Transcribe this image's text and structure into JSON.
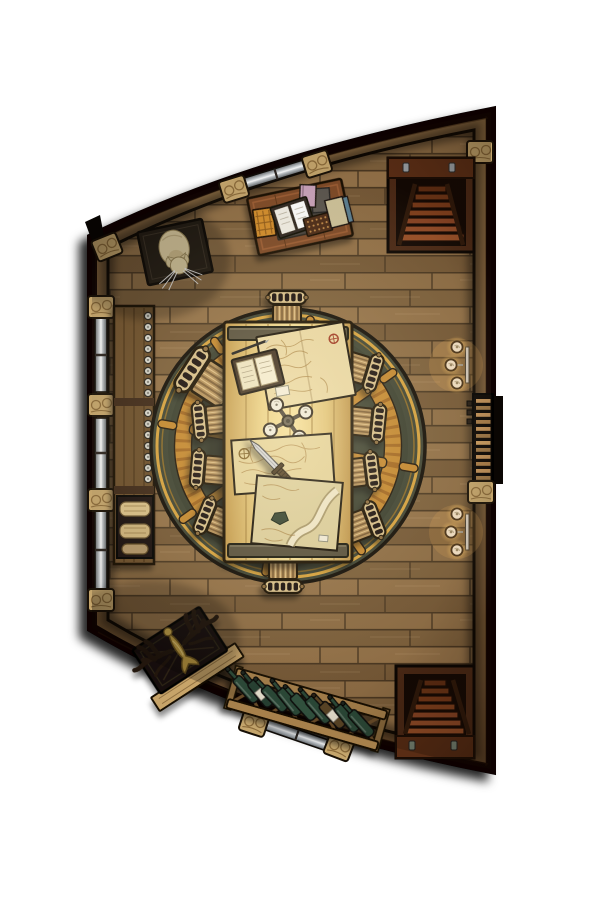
{
  "scene": {
    "kind": "top-down-vtt-battle-map",
    "setting_label": "Ship captain's chart cabin (top-down)",
    "counts": {
      "chairs": 10,
      "wine_bottles": 9,
      "sconce_candles_each": 3,
      "left_wall_windows": 3,
      "staircases": 2,
      "table_maps": 3
    },
    "palette": {
      "page_bg": "#ffffff",
      "outline_black": "#070402",
      "wall_wood": "#7d5e3a",
      "wall_joint": "#c4a56c",
      "floor_wood": "#85663f",
      "floor_seam": "#4a3721",
      "rug_green": "#3c4233",
      "rug_gold": "#d9a43e",
      "wheel_orange": "#c6882e",
      "table_wood": "#e9cf82",
      "table_cap": "#57503e",
      "parchment": "#e9d8a5",
      "bottle_green": "#2c4a38",
      "candle_glow": "#ffdf9a",
      "stair_frame": "#4a2815",
      "step_wood": "#8a4424",
      "ladder_rung": "#c09058",
      "window_glass": "#e9edf0",
      "cat_fur": "#ecdbac",
      "antler_dark": "#241507",
      "figure_gold": "#bf9c42"
    },
    "objects": {
      "map": {
        "label": "Captain's cabin battle map"
      },
      "floor": {
        "label": "Wooden plank floor"
      },
      "walls": {
        "label": "Curved timber hull walls"
      },
      "window_top": {
        "label": "Hull window, top wall"
      },
      "windows_left": {
        "label": "Hull windows, left wall"
      },
      "window_bottom": {
        "label": "Hull window, bottom wall"
      },
      "stairs_top": {
        "label": "Staircase below deck, upper right"
      },
      "stairs_bottom": {
        "label": "Staircase below deck, lower right"
      },
      "ladder": {
        "label": "Deck ladder opening, right wall"
      },
      "sconce_upper": {
        "label": "Triple-candle wall sconce, upper"
      },
      "sconce_lower": {
        "label": "Triple-candle wall sconce, lower"
      },
      "desk": {
        "label": "Writing desk with open book and journals"
      },
      "cat": {
        "label": "Sleeping ship's cat on a mat"
      },
      "sideboard": {
        "label": "Sideboard shelf with vials"
      },
      "scroll_crate": {
        "label": "Crate of rolled charts"
      },
      "rug": {
        "label": "Round rug with ship's wheel motif"
      },
      "table": {
        "label": "Chart table"
      },
      "chair": {
        "label": "Slatted wooden chair"
      },
      "ledger": {
        "label": "Open ledger with quill"
      },
      "map_a": {
        "label": "Nautical chart, top of table"
      },
      "map_b": {
        "label": "Nautical chart with dagger"
      },
      "map_c": {
        "label": "River chart"
      },
      "candelabra": {
        "label": "Four-arm candelabra"
      },
      "dagger": {
        "label": "Dagger on chart"
      },
      "antler_chair": {
        "label": "Antler-backed captain's chair"
      },
      "wine_rack": {
        "label": "Wine rack with bottles"
      }
    }
  }
}
